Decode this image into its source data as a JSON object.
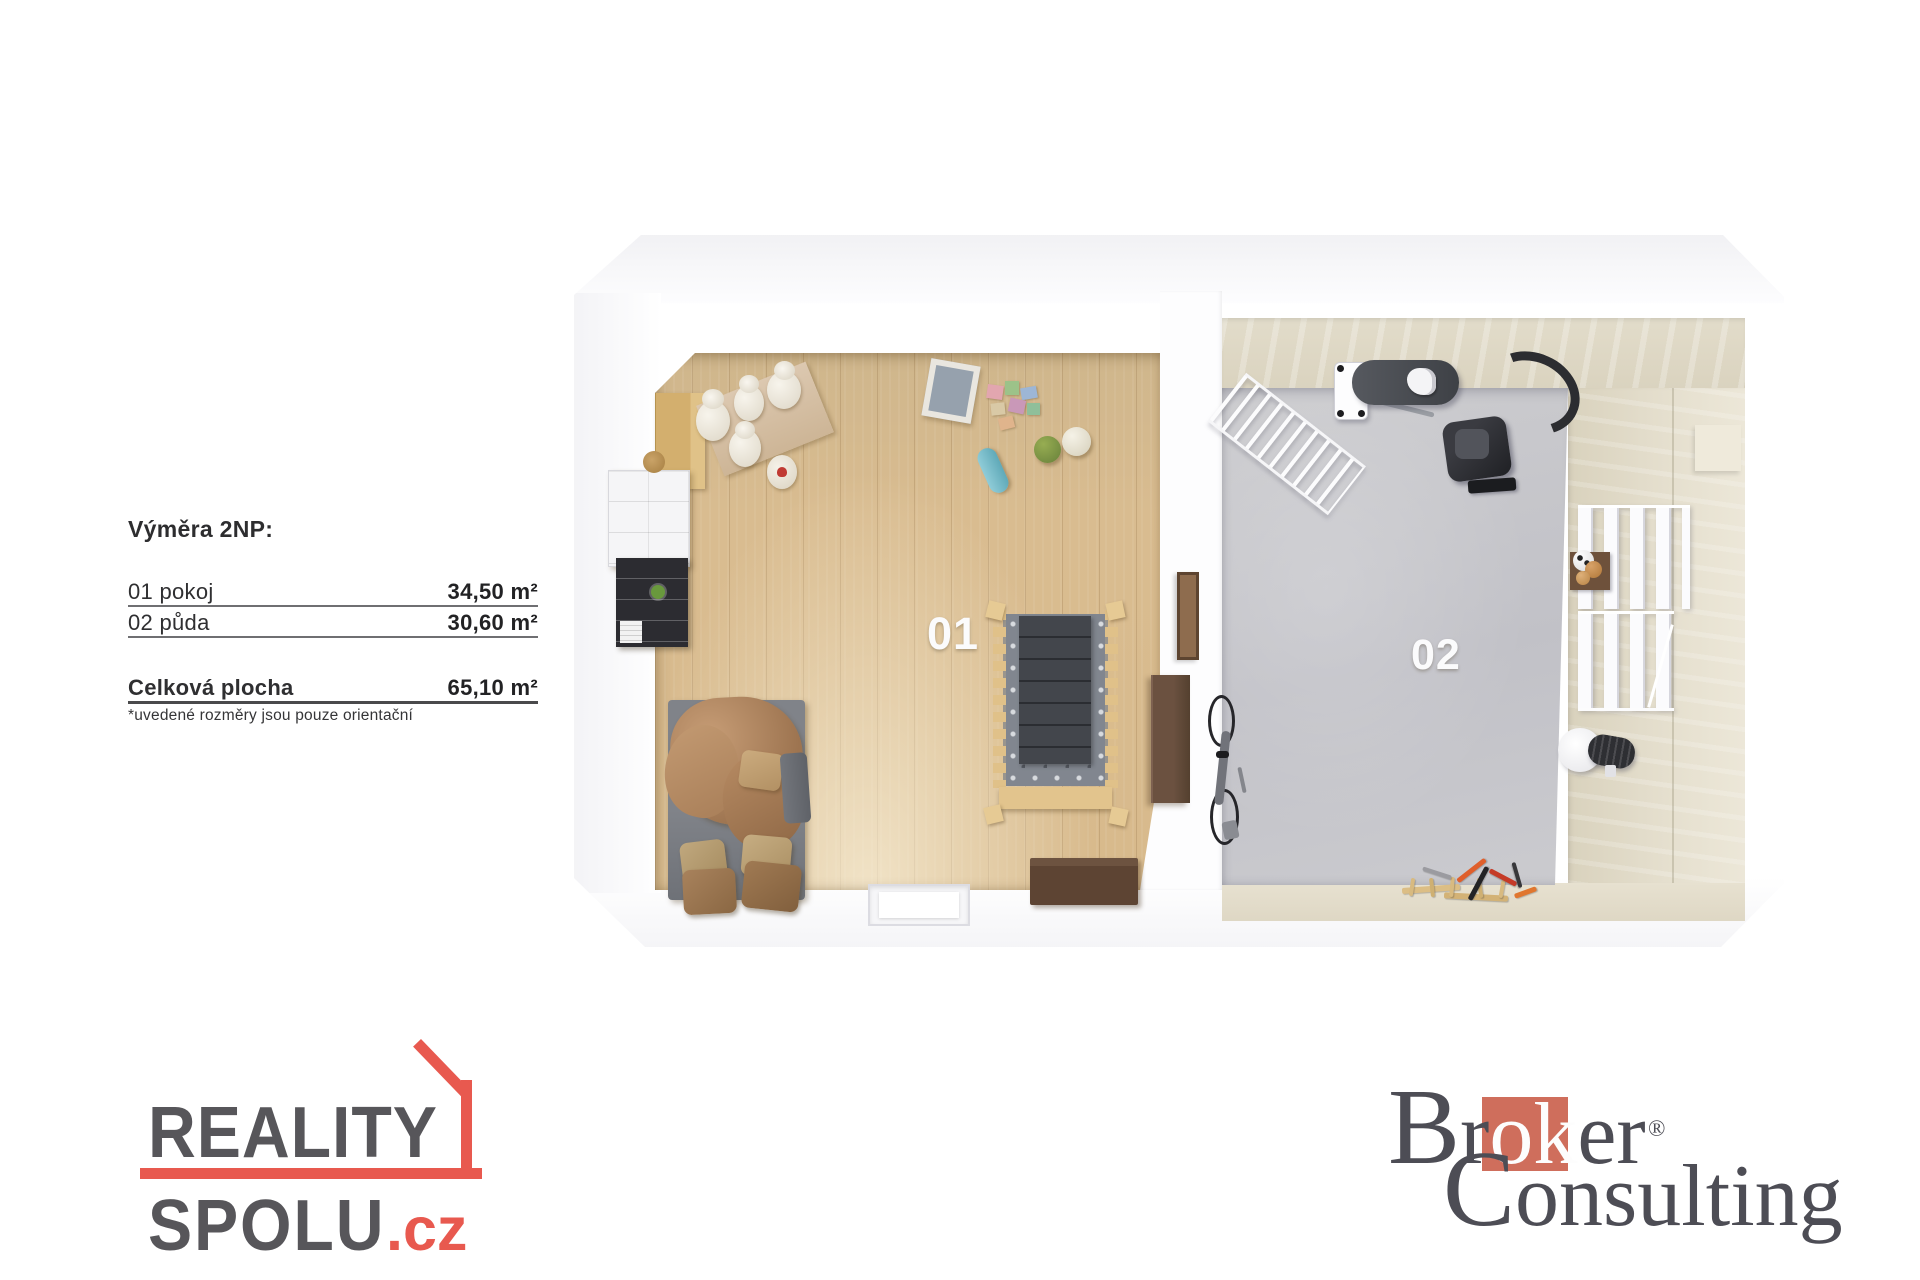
{
  "info": {
    "title": "Výměra 2NP:",
    "rows": [
      {
        "label": "01 pokoj",
        "value": "34,50 m²"
      },
      {
        "label": "02 půda",
        "value": "30,60 m²"
      }
    ],
    "total": {
      "label": "Celková plocha",
      "value": "65,10 m²"
    },
    "footnote": "*uvedené rozměry jsou pouze orientační"
  },
  "floorplan": {
    "room1_label": "01",
    "room2_label": "02",
    "icons": [
      "wardrobe",
      "white-cabinet",
      "black-shelf",
      "teddy-bears",
      "toy-blocks",
      "picture-frame",
      "green-ball",
      "white-ball",
      "skateboard",
      "crib",
      "bed",
      "pillows",
      "dresser",
      "wall-frame",
      "chest",
      "floor-hatch",
      "drying-rack",
      "ironing-board",
      "iron",
      "vacuum-cleaner",
      "wall-shelves",
      "balls-box",
      "soccer-ball",
      "fan",
      "bicycle",
      "tools"
    ]
  },
  "logos": {
    "reality": {
      "line1": "REALITY",
      "line2": "SPOLU",
      "tld": ".cz",
      "gray": "#57565a",
      "red": "#e8594f"
    },
    "broker": {
      "b": "B",
      "r": "r",
      "ok": "ok",
      "er": "er",
      "reg": "®",
      "c": "C",
      "onsulting": "onsulting",
      "text": "#4d4d55",
      "red": "#cf6e5c"
    }
  },
  "colors": {
    "wood_floor": "#d8ba8c",
    "concrete_floor": "#c6c6cb",
    "attic_wall": "#e0dac8",
    "wall_white": "#fdfdfe"
  }
}
